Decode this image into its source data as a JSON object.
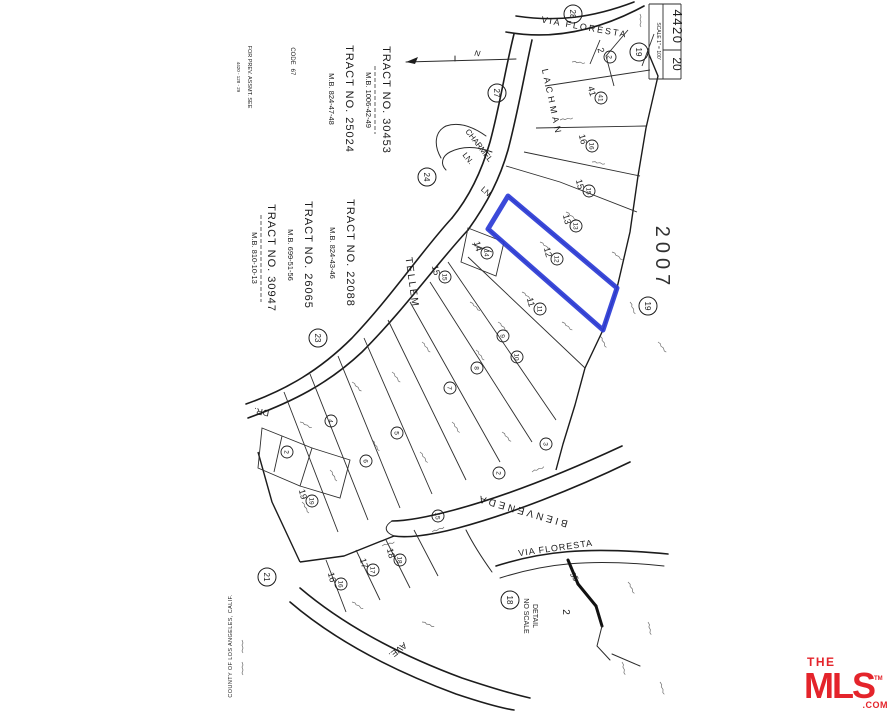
{
  "page": {
    "background": "#FFFFFF",
    "ink": "#1C1C1C"
  },
  "highlight": {
    "lot": "12",
    "color": "#2B3BD6"
  },
  "sheet": {
    "book": "4420",
    "page": "20",
    "scale": "SCALE 1\" = 100'"
  },
  "stamp_year": "2007",
  "notes": {
    "prev_assmt_1": "FOR PREV. ASSMT. SEE",
    "prev_assmt_2": "4420 - 128 - 29",
    "code_label": "CODE",
    "code_value": "67",
    "county": "COUNTY OF LOS ANGELES, CALIF.",
    "north": "N"
  },
  "tracts": [
    {
      "name": "TRACT NO. 30453",
      "mb": "M.B. 1006-42-49"
    },
    {
      "name": "TRACT NO. 25024",
      "mb": "M.B. 824-47-48"
    },
    {
      "name": "TRACT NO. 22088",
      "mb": "M.B. 824-43-46"
    },
    {
      "name": "TRACT NO. 26065",
      "mb": "M.B. 699-51-56"
    },
    {
      "name": "TRACT NO. 30947",
      "mb": "M.B. 810-10-13"
    }
  ],
  "streets": {
    "via_floresta_top": "VIA FLORESTA",
    "lachman": "LACHMAN",
    "charmel_line1": "CHARMEL",
    "charmel_line2": "LN.",
    "ln_suffix": "LN.",
    "tellem": "TELLEM",
    "dr_suffix": "DR.",
    "bienveneda": "BIENVENEDA",
    "ave_suffix": "AVE.",
    "via_floresta_bottom": "VIA FLORESTA"
  },
  "detail_inset": {
    "line1": "DETAIL",
    "line2": "NO SCALE",
    "lot": "2",
    "dim": "35"
  },
  "junctions": [
    {
      "n": "28",
      "x": 573,
      "y": 14
    },
    {
      "n": "19",
      "x": 639,
      "y": 52
    },
    {
      "n": "27",
      "x": 497,
      "y": 93
    },
    {
      "n": "24",
      "x": 427,
      "y": 177
    },
    {
      "n": "23",
      "x": 318,
      "y": 338
    },
    {
      "n": "21",
      "x": 267,
      "y": 577
    },
    {
      "n": "18",
      "x": 510,
      "y": 600
    },
    {
      "n": "19",
      "x": 648,
      "y": 306
    }
  ],
  "lots": [
    {
      "n": "2",
      "x": 610,
      "y": 57,
      "plain": true
    },
    {
      "n": "41",
      "x": 601,
      "y": 98,
      "plain": true
    },
    {
      "n": "16",
      "x": 592,
      "y": 146,
      "plain": true
    },
    {
      "n": "15",
      "x": 589,
      "y": 191,
      "plain": true
    },
    {
      "n": "13",
      "x": 576,
      "y": 226,
      "plain": true
    },
    {
      "n": "12",
      "x": 557,
      "y": 259,
      "plain": true
    },
    {
      "n": "14",
      "x": 487,
      "y": 253,
      "plain": true
    },
    {
      "n": "11",
      "x": 540,
      "y": 309,
      "plain": true
    },
    {
      "n": "15",
      "x": 445,
      "y": 277,
      "plain": true
    },
    {
      "n": "9",
      "x": 503,
      "y": 336
    },
    {
      "n": "10",
      "x": 517,
      "y": 357
    },
    {
      "n": "8",
      "x": 477,
      "y": 368
    },
    {
      "n": "7",
      "x": 450,
      "y": 388
    },
    {
      "n": "5",
      "x": 397,
      "y": 433
    },
    {
      "n": "6",
      "x": 366,
      "y": 461
    },
    {
      "n": "4",
      "x": 331,
      "y": 421
    },
    {
      "n": "2",
      "x": 287,
      "y": 452
    },
    {
      "n": "3",
      "x": 546,
      "y": 444
    },
    {
      "n": "2",
      "x": 499,
      "y": 473
    },
    {
      "n": "19",
      "x": 312,
      "y": 501,
      "plain": true
    },
    {
      "n": "15",
      "x": 438,
      "y": 516
    },
    {
      "n": "18",
      "x": 400,
      "y": 560,
      "plain": true
    },
    {
      "n": "17",
      "x": 373,
      "y": 570,
      "plain": true
    },
    {
      "n": "16",
      "x": 341,
      "y": 584,
      "plain": true
    }
  ],
  "logo": {
    "the": "THE",
    "mls": "MLS",
    "tm": "TM",
    "com": ".COM",
    "color": "#E4242B"
  }
}
